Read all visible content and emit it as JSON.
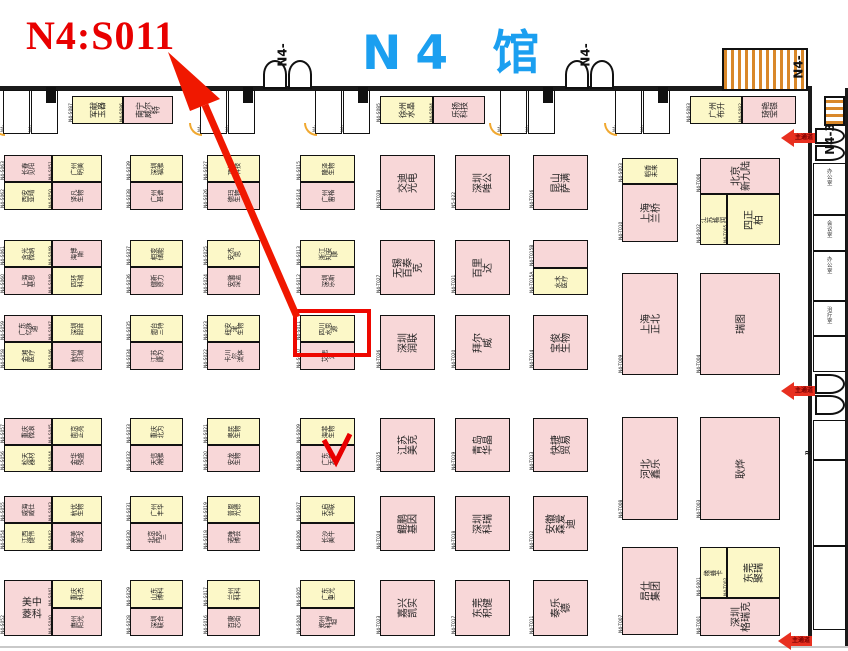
{
  "annotation": {
    "headline": "N4:S011",
    "hall_title": "N4 馆",
    "highlighted_booth": "N4-S011",
    "aisle_label": "主通道"
  },
  "colors": {
    "highlight": "#ee0800",
    "arrow": "#f01800",
    "booth_yellow": "#fcf8c8",
    "booth_pink": "#f8d7d8",
    "title_blue": "#1b9ff0",
    "headline_red": "#e80000"
  },
  "gate_labels": [
    {
      "text": "N4-",
      "x": 271,
      "y": 48
    },
    {
      "text": "N4-",
      "x": 574,
      "y": 48
    },
    {
      "text": "N4-",
      "x": 787,
      "y": 60
    },
    {
      "text": "N4-3",
      "x": 814,
      "y": 132
    }
  ],
  "top_rooms": [
    {
      "id": "N4-",
      "x": 3
    },
    {
      "id": "N4-",
      "x": 31
    },
    {
      "id": "N4-",
      "x": 200
    },
    {
      "id": "N4-",
      "x": 228
    },
    {
      "id": "N4-",
      "x": 315
    },
    {
      "id": "N4-",
      "x": 343
    },
    {
      "id": "N4-",
      "x": 500
    },
    {
      "id": "N4-",
      "x": 528
    },
    {
      "id": "N4-",
      "x": 615
    },
    {
      "id": "N4-",
      "x": 643
    }
  ],
  "right_rooms": [
    {
      "label": "办公室",
      "y": 163,
      "h": 52
    },
    {
      "label": "会议室",
      "y": 215,
      "h": 36
    },
    {
      "label": "办公室",
      "y": 251,
      "h": 50
    },
    {
      "label": "治疗室",
      "y": 301,
      "h": 35
    },
    {
      "label": "",
      "y": 336,
      "h": 36
    },
    {
      "label": "",
      "y": 420,
      "h": 40
    },
    {
      "label": "",
      "y": 460,
      "h": 86
    },
    {
      "label": "",
      "y": 546,
      "h": 84
    }
  ],
  "booths": [
    {
      "id": "N4-S087",
      "name": "军献\n玉器",
      "x": 72,
      "y": 96,
      "w": 51,
      "h": 28,
      "c": "y",
      "nm": "m"
    },
    {
      "id": "N4-S086",
      "name": "南宁\n威尔特",
      "x": 123,
      "y": 96,
      "w": 50,
      "h": 28,
      "c": "p",
      "nm": "m"
    },
    {
      "id": "N4-S085",
      "name": "徐州\n水晶",
      "x": 380,
      "y": 96,
      "w": 53,
      "h": 28,
      "c": "y",
      "nm": "m"
    },
    {
      "id": "N4-S084",
      "name": "乐扬\n科技",
      "x": 433,
      "y": 96,
      "w": 52,
      "h": 28,
      "c": "p",
      "nm": "m"
    },
    {
      "id": "N4-S083",
      "name": "广州\n布升",
      "x": 690,
      "y": 96,
      "w": 52,
      "h": 28,
      "c": "y",
      "nm": "m"
    },
    {
      "id": "N4-S082",
      "name": "琦艳\n宝银",
      "x": 742,
      "y": 96,
      "w": 54,
      "h": 28,
      "c": "p",
      "nm": "m"
    },
    {
      "id": "N4-S063",
      "name": "长春\n见阳",
      "x": 4,
      "y": 155,
      "w": 48,
      "h": 27,
      "c": "p",
      "nm": "s"
    },
    {
      "id": "N4-S062",
      "name": "西安\n亚晴",
      "x": 4,
      "y": 182,
      "w": 48,
      "h": 28,
      "c": "y",
      "nm": "s"
    },
    {
      "id": "N4-S051",
      "name": "广州\n明美",
      "x": 52,
      "y": 155,
      "w": 50,
      "h": 27,
      "c": "y",
      "nm": "s"
    },
    {
      "id": "N4-S050",
      "name": "译凡\n生物",
      "x": 52,
      "y": 182,
      "w": 50,
      "h": 28,
      "c": "p",
      "nm": "s"
    },
    {
      "id": "N4-S061",
      "name": "含光\n微纳",
      "x": 4,
      "y": 240,
      "w": 48,
      "h": 27,
      "c": "y",
      "nm": "s"
    },
    {
      "id": "N4-S060",
      "name": "上海\n基恩",
      "x": 4,
      "y": 267,
      "w": 48,
      "h": 28,
      "c": "p",
      "nm": "s"
    },
    {
      "id": "N4-S049",
      "name": "海博\n斯",
      "x": 52,
      "y": 240,
      "w": 50,
      "h": 27,
      "c": "p",
      "nm": "s"
    },
    {
      "id": "N4-S048",
      "name": "四环\n科瑞",
      "x": 52,
      "y": 267,
      "w": 50,
      "h": 28,
      "c": "y",
      "nm": "s"
    },
    {
      "id": "N4-S059",
      "name": "广东\n亿脉通",
      "x": 4,
      "y": 315,
      "w": 48,
      "h": 27,
      "c": "p",
      "nm": "s"
    },
    {
      "id": "N4-S058",
      "name": "金湘\n医疗",
      "x": 4,
      "y": 342,
      "w": 48,
      "h": 28,
      "c": "y",
      "nm": "s"
    },
    {
      "id": "N4-S047",
      "name": "深圳\n韶音",
      "x": 52,
      "y": 315,
      "w": 50,
      "h": 27,
      "c": "y",
      "nm": "s"
    },
    {
      "id": "N4-S046",
      "name": "杭州\n贝瑞",
      "x": 52,
      "y": 342,
      "w": 50,
      "h": 28,
      "c": "p",
      "nm": "s"
    },
    {
      "id": "N4-S057",
      "name": "重庆\n微浪",
      "x": 4,
      "y": 418,
      "w": 48,
      "h": 27,
      "c": "p",
      "nm": "s"
    },
    {
      "id": "N4-S056",
      "name": "松天\n器材",
      "x": 4,
      "y": 445,
      "w": 48,
      "h": 27,
      "c": "y",
      "nm": "s"
    },
    {
      "id": "N4-S045",
      "name": "南京\n正亮",
      "x": 52,
      "y": 418,
      "w": 50,
      "h": 27,
      "c": "y",
      "nm": "s"
    },
    {
      "id": "N4-S044",
      "name": "金华\n强盛",
      "x": 52,
      "y": 445,
      "w": 50,
      "h": 27,
      "c": "p",
      "nm": "s"
    },
    {
      "id": "N4-S055",
      "name": "威海\n威仕",
      "x": 4,
      "y": 496,
      "w": 48,
      "h": 27,
      "c": "p",
      "nm": "s"
    },
    {
      "id": "N4-S054",
      "name": "江西\n健伟",
      "x": 4,
      "y": 523,
      "w": 48,
      "h": 28,
      "c": "y",
      "nm": "s"
    },
    {
      "id": "N4-S043",
      "name": "杭优\n生物",
      "x": 52,
      "y": 496,
      "w": 50,
      "h": 27,
      "c": "y",
      "nm": "s"
    },
    {
      "id": "N4-S042",
      "name": "亮美\n泰戈",
      "x": 52,
      "y": 523,
      "w": 50,
      "h": 28,
      "c": "p",
      "nm": "s"
    },
    {
      "id": "N4-S052",
      "name": "中科美菱",
      "x": 4,
      "y": 580,
      "w": 48,
      "h": 56,
      "c": "p",
      "nm": "u"
    },
    {
      "id": "N4-S041",
      "name": "重庆\n科杰",
      "x": 52,
      "y": 580,
      "w": 50,
      "h": 28,
      "c": "y",
      "nm": "s"
    },
    {
      "id": "N4-S040",
      "name": "惠州\n阳光",
      "x": 52,
      "y": 608,
      "w": 50,
      "h": 28,
      "c": "p",
      "nm": "s"
    },
    {
      "id": "N4-S039",
      "name": "深圳\n福雅",
      "x": 130,
      "y": 155,
      "w": 53,
      "h": 27,
      "c": "y",
      "nm": "s"
    },
    {
      "id": "N4-S038",
      "name": "广州\n甚谱",
      "x": 130,
      "y": 182,
      "w": 53,
      "h": 28,
      "c": "p",
      "nm": "s"
    },
    {
      "id": "N4-S037",
      "name": "相变\n储能",
      "x": 130,
      "y": 240,
      "w": 53,
      "h": 27,
      "c": "y",
      "nm": "s"
    },
    {
      "id": "N4-S036",
      "name": "健新\n原力",
      "x": 130,
      "y": 267,
      "w": 53,
      "h": 28,
      "c": "p",
      "nm": "s"
    },
    {
      "id": "N4-S035",
      "name": "烟台\n三特",
      "x": 130,
      "y": 315,
      "w": 53,
      "h": 27,
      "c": "y",
      "nm": "s"
    },
    {
      "id": "N4-S034",
      "name": "江苏\n康为",
      "x": 130,
      "y": 342,
      "w": 53,
      "h": 28,
      "c": "p",
      "nm": "s"
    },
    {
      "id": "N4-S033",
      "name": "重庆\n北为",
      "x": 130,
      "y": 418,
      "w": 53,
      "h": 27,
      "c": "y",
      "nm": "s"
    },
    {
      "id": "N4-S032",
      "name": "天信\n潮雅",
      "x": 130,
      "y": 445,
      "w": 53,
      "h": 27,
      "c": "p",
      "nm": "s"
    },
    {
      "id": "N4-S031",
      "name": "广州\n丰华",
      "x": 130,
      "y": 496,
      "w": 53,
      "h": 27,
      "c": "y",
      "nm": "s"
    },
    {
      "id": "N4-S030",
      "name": "北京\n西克兰",
      "x": 130,
      "y": 523,
      "w": 53,
      "h": 28,
      "c": "p",
      "nm": "s"
    },
    {
      "id": "N4-S029",
      "name": "山东\n博科",
      "x": 130,
      "y": 580,
      "w": 53,
      "h": 28,
      "c": "y",
      "nm": "s"
    },
    {
      "id": "N4-S028",
      "name": "深圳\n联合",
      "x": 130,
      "y": 608,
      "w": 53,
      "h": 28,
      "c": "p",
      "nm": "s"
    },
    {
      "id": "N4-S027",
      "name": "顶俐\n科技",
      "x": 207,
      "y": 155,
      "w": 53,
      "h": 27,
      "c": "y",
      "nm": "s"
    },
    {
      "id": "N4-S026",
      "name": "德玛\n生物",
      "x": 207,
      "y": 182,
      "w": 53,
      "h": 28,
      "c": "p",
      "nm": "s"
    },
    {
      "id": "N4-S025",
      "name": "安杰思",
      "x": 207,
      "y": 240,
      "w": 53,
      "h": 27,
      "c": "y",
      "nm": "s"
    },
    {
      "id": "N4-S024",
      "name": "安徽\n深蓝",
      "x": 207,
      "y": 267,
      "w": 53,
      "h": 28,
      "c": "p",
      "nm": "s"
    },
    {
      "id": "N4-S023",
      "name": "纽安津\n生物",
      "x": 207,
      "y": 315,
      "w": 53,
      "h": 27,
      "c": "y",
      "nm": "s"
    },
    {
      "id": "N4-S022",
      "name": "卡川尔\n流体",
      "x": 207,
      "y": 342,
      "w": 53,
      "h": 28,
      "c": "p",
      "nm": "s"
    },
    {
      "id": "N4-S021",
      "name": "奥民\n生物",
      "x": 207,
      "y": 418,
      "w": 53,
      "h": 27,
      "c": "y",
      "nm": "s"
    },
    {
      "id": "N4-S020",
      "name": "安龙\n生物",
      "x": 207,
      "y": 445,
      "w": 53,
      "h": 27,
      "c": "p",
      "nm": "s"
    },
    {
      "id": "N4-S019",
      "name": "普恩\n光德",
      "x": 207,
      "y": 496,
      "w": 53,
      "h": 27,
      "c": "y",
      "nm": "s"
    },
    {
      "id": "N4-S018",
      "name": "诺唯\n博芸",
      "x": 207,
      "y": 523,
      "w": 53,
      "h": 28,
      "c": "p",
      "nm": "s"
    },
    {
      "id": "N4-S017",
      "name": "兰州\n科科",
      "x": 207,
      "y": 580,
      "w": 53,
      "h": 28,
      "c": "y",
      "nm": "s"
    },
    {
      "id": "N4-S016",
      "name": "百康\n芯街",
      "x": 207,
      "y": 608,
      "w": 53,
      "h": 28,
      "c": "p",
      "nm": "s"
    },
    {
      "id": "N4-S015",
      "name": "隆泽\n生物",
      "x": 300,
      "y": 155,
      "w": 55,
      "h": 27,
      "c": "y",
      "nm": "s"
    },
    {
      "id": "N4-S014",
      "name": "广州\n雷格",
      "x": 300,
      "y": 182,
      "w": 55,
      "h": 28,
      "c": "p",
      "nm": "s"
    },
    {
      "id": "N4-S013",
      "name": "浙江\n知安康",
      "x": 300,
      "y": 240,
      "w": 55,
      "h": 27,
      "c": "y",
      "nm": "s"
    },
    {
      "id": "N4-S012",
      "name": "深圳\n乐斯",
      "x": 300,
      "y": 267,
      "w": 55,
      "h": 28,
      "c": "p",
      "nm": "s"
    },
    {
      "id": "N4-S011",
      "name": "四川\n水思源",
      "x": 300,
      "y": 315,
      "w": 55,
      "h": 27,
      "c": "y",
      "nm": "s"
    },
    {
      "id": "N4-S010",
      "name": "艾思达",
      "x": 300,
      "y": 342,
      "w": 55,
      "h": 28,
      "c": "p",
      "nm": "s"
    },
    {
      "id": "N4-S009",
      "name": "海菲\n生物",
      "x": 300,
      "y": 418,
      "w": 55,
      "h": 27,
      "c": "y",
      "nm": "s"
    },
    {
      "id": "N4-S008",
      "name": "广东\n天普",
      "x": 300,
      "y": 445,
      "w": 55,
      "h": 27,
      "c": "p",
      "nm": "s"
    },
    {
      "id": "N4-S007",
      "name": "天启\n华联",
      "x": 300,
      "y": 496,
      "w": 55,
      "h": 27,
      "c": "y",
      "nm": "s"
    },
    {
      "id": "N4-S006",
      "name": "长沙\n美牛",
      "x": 300,
      "y": 523,
      "w": 55,
      "h": 28,
      "c": "p",
      "nm": "s"
    },
    {
      "id": "N4-S005",
      "name": "广东\n重光",
      "x": 300,
      "y": 580,
      "w": 55,
      "h": 28,
      "c": "y",
      "nm": "s"
    },
    {
      "id": "N4-S004",
      "name": "郑州\n科睿坦",
      "x": 300,
      "y": 608,
      "w": 55,
      "h": 28,
      "c": "p",
      "nm": "s"
    },
    {
      "id": "N4-T028",
      "name": "交迪 光电",
      "x": 380,
      "y": 155,
      "w": 55,
      "h": 55,
      "c": "p",
      "nm": "r"
    },
    {
      "id": "N4-T027",
      "name": "无锡百泰克",
      "x": 380,
      "y": 240,
      "w": 55,
      "h": 55,
      "c": "p",
      "nm": "r"
    },
    {
      "id": "N4-T026",
      "name": "深圳润联",
      "x": 380,
      "y": 315,
      "w": 55,
      "h": 55,
      "c": "p",
      "nm": "r"
    },
    {
      "id": "N4-T025",
      "name": "江苏美克",
      "x": 380,
      "y": 418,
      "w": 55,
      "h": 54,
      "c": "p",
      "nm": "r"
    },
    {
      "id": "N4-T024",
      "name": "鲲鹏基因",
      "x": 380,
      "y": 496,
      "w": 55,
      "h": 55,
      "c": "p",
      "nm": "r"
    },
    {
      "id": "N4-T023",
      "name": "嘉兴凯实",
      "x": 380,
      "y": 580,
      "w": 55,
      "h": 56,
      "c": "p",
      "nm": "r"
    },
    {
      "id": "N5-022",
      "name": "深圳唯公",
      "x": 455,
      "y": 155,
      "w": 55,
      "h": 55,
      "c": "p",
      "nm": "r"
    },
    {
      "id": "N4-T021",
      "name": "百里达",
      "x": 455,
      "y": 240,
      "w": 55,
      "h": 55,
      "c": "p",
      "nm": "r"
    },
    {
      "id": "N4-T020",
      "name": "拜尔威",
      "x": 455,
      "y": 315,
      "w": 55,
      "h": 55,
      "c": "p",
      "nm": "r"
    },
    {
      "id": "N4-T019",
      "name": "青岛华晶",
      "x": 455,
      "y": 418,
      "w": 55,
      "h": 54,
      "c": "p",
      "nm": "r"
    },
    {
      "id": "N4-T018",
      "name": "深圳科瑞",
      "x": 455,
      "y": 496,
      "w": 55,
      "h": 55,
      "c": "p",
      "nm": "r"
    },
    {
      "id": "N4-T017",
      "name": "东莞积健",
      "x": 455,
      "y": 580,
      "w": 55,
      "h": 56,
      "c": "p",
      "nm": "r"
    },
    {
      "id": "N4-T016",
      "name": "昆山萨满",
      "x": 533,
      "y": 155,
      "w": 55,
      "h": 55,
      "c": "p",
      "nm": "r"
    },
    {
      "id": "N4-T015B",
      "name": "",
      "x": 533,
      "y": 240,
      "w": 55,
      "h": 28,
      "c": "p",
      "nm": "s"
    },
    {
      "id": "N4-T015A",
      "name": "水木\n医疗",
      "x": 533,
      "y": 268,
      "w": 55,
      "h": 27,
      "c": "y",
      "nm": "s"
    },
    {
      "id": "N4-T014",
      "name": "宝俊生物",
      "x": 533,
      "y": 315,
      "w": 55,
      "h": 55,
      "c": "p",
      "nm": "r"
    },
    {
      "id": "N4-T013",
      "name": "快捷贸易",
      "x": 533,
      "y": 418,
      "w": 55,
      "h": 54,
      "c": "p",
      "nm": "r"
    },
    {
      "id": "N4-T012",
      "name": "安徽森爱迪",
      "x": 533,
      "y": 496,
      "w": 55,
      "h": 55,
      "c": "p",
      "nm": "r"
    },
    {
      "id": "N4-T011",
      "name": "泰乐德",
      "x": 533,
      "y": 580,
      "w": 55,
      "h": 56,
      "c": "p",
      "nm": "r"
    },
    {
      "id": "N4-S003",
      "name": "稻香\n未来",
      "x": 622,
      "y": 158,
      "w": 56,
      "h": 26,
      "c": "y",
      "nm": "s"
    },
    {
      "id": "N4-T010",
      "name": "上海兰桥",
      "x": 622,
      "y": 184,
      "w": 56,
      "h": 58,
      "c": "p",
      "nm": "r"
    },
    {
      "id": "N4-T009",
      "name": "上海正北",
      "x": 622,
      "y": 273,
      "w": 56,
      "h": 102,
      "c": "p",
      "nm": "r"
    },
    {
      "id": "N4-T008",
      "name": "河北鑫乐",
      "x": 622,
      "y": 417,
      "w": 56,
      "h": 103,
      "c": "p",
      "nm": "r"
    },
    {
      "id": "N4-T007",
      "name": "昂仕集团",
      "x": 622,
      "y": 547,
      "w": 56,
      "h": 88,
      "c": "p",
      "nm": "r"
    },
    {
      "id": "N4-T006",
      "name": "北京\n新九陆",
      "x": 700,
      "y": 158,
      "w": 80,
      "h": 36,
      "c": "p",
      "nm": "r"
    },
    {
      "id": "N4-S002",
      "name": "江苏\n格润",
      "x": 700,
      "y": 194,
      "w": 27,
      "h": 51,
      "c": "y",
      "nm": "s"
    },
    {
      "id": "N4-T005",
      "name": "四正柏",
      "x": 727,
      "y": 194,
      "w": 53,
      "h": 51,
      "c": "y",
      "nm": "r"
    },
    {
      "id": "N4-T004",
      "name": "瑞图",
      "x": 700,
      "y": 273,
      "w": 80,
      "h": 102,
      "c": "p",
      "nm": "r"
    },
    {
      "id": "N4-T003",
      "name": "耿烨",
      "x": 700,
      "y": 417,
      "w": 80,
      "h": 103,
      "c": "p",
      "nm": "r"
    },
    {
      "id": "N4-S001",
      "name": "缘蜂卡",
      "x": 700,
      "y": 547,
      "w": 27,
      "h": 51,
      "c": "y",
      "nm": "s"
    },
    {
      "id": "N4-T002",
      "name": "东莞聚瑞",
      "x": 727,
      "y": 547,
      "w": 53,
      "h": 51,
      "c": "y",
      "nm": "r"
    },
    {
      "id": "N4-T001",
      "name": "深圳\n格瑞克",
      "x": 700,
      "y": 598,
      "w": 80,
      "h": 38,
      "c": "p",
      "nm": "r"
    }
  ],
  "highlight_rect": {
    "x": 293,
    "y": 309,
    "w": 70,
    "h": 40
  },
  "aisle_arrows": [
    {
      "x": 781,
      "y": 129
    },
    {
      "x": 781,
      "y": 382
    },
    {
      "x": 778,
      "y": 632
    }
  ]
}
